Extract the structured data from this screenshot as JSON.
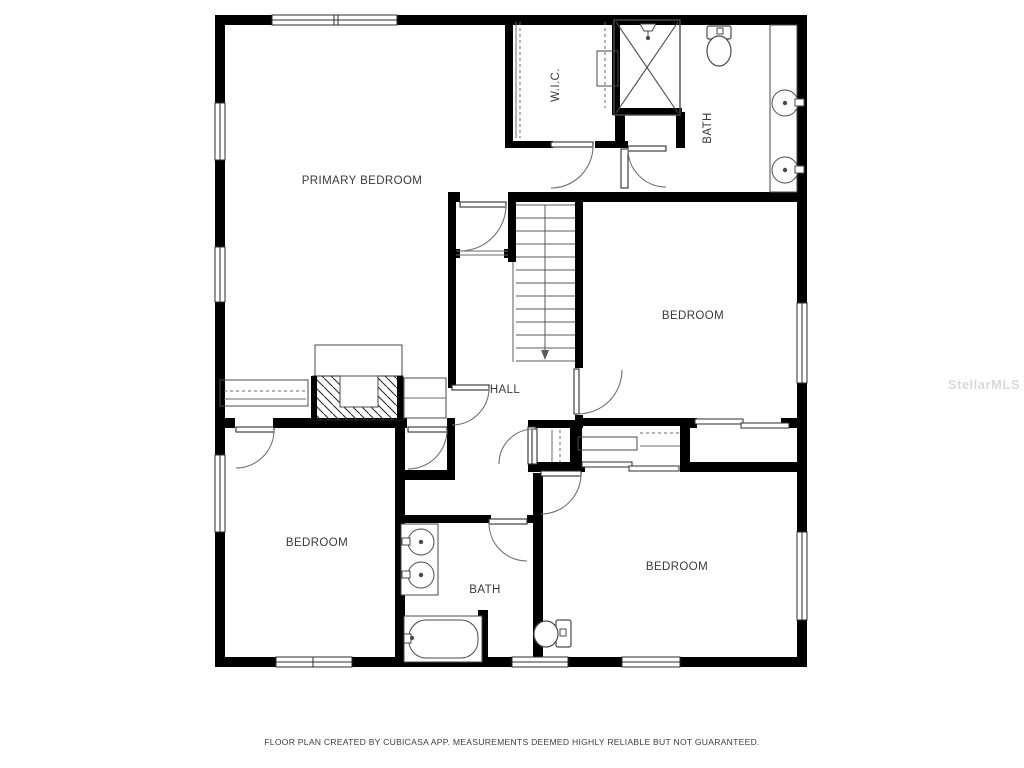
{
  "plan": {
    "colors": {
      "wall": "#000000",
      "label": "#3a3a3a",
      "watermark": "#d9d9d9"
    },
    "rooms": {
      "primary_bedroom": {
        "label": "PRIMARY BEDROOM"
      },
      "wic": {
        "label": "W.I.C."
      },
      "bath_top": {
        "label": "BATH"
      },
      "bedroom_right": {
        "label": "BEDROOM"
      },
      "hall": {
        "label": "HALL"
      },
      "bedroom_left": {
        "label": "BEDROOM"
      },
      "bath_bottom": {
        "label": "BATH"
      },
      "bedroom_bottom_right": {
        "label": "BEDROOM"
      }
    },
    "fixtures": [
      "shower",
      "toilet",
      "double-vanity",
      "bathtub",
      "single-toilet",
      "stairs-down",
      "fireplace",
      "closet-rods",
      "sliding-doors"
    ]
  },
  "footer": {
    "disclaimer": "FLOOR PLAN CREATED BY CUBICASA APP. MEASUREMENTS DEEMED HIGHLY RELIABLE BUT NOT GUARANTEED."
  },
  "watermark": {
    "text": "StellarMLS"
  }
}
